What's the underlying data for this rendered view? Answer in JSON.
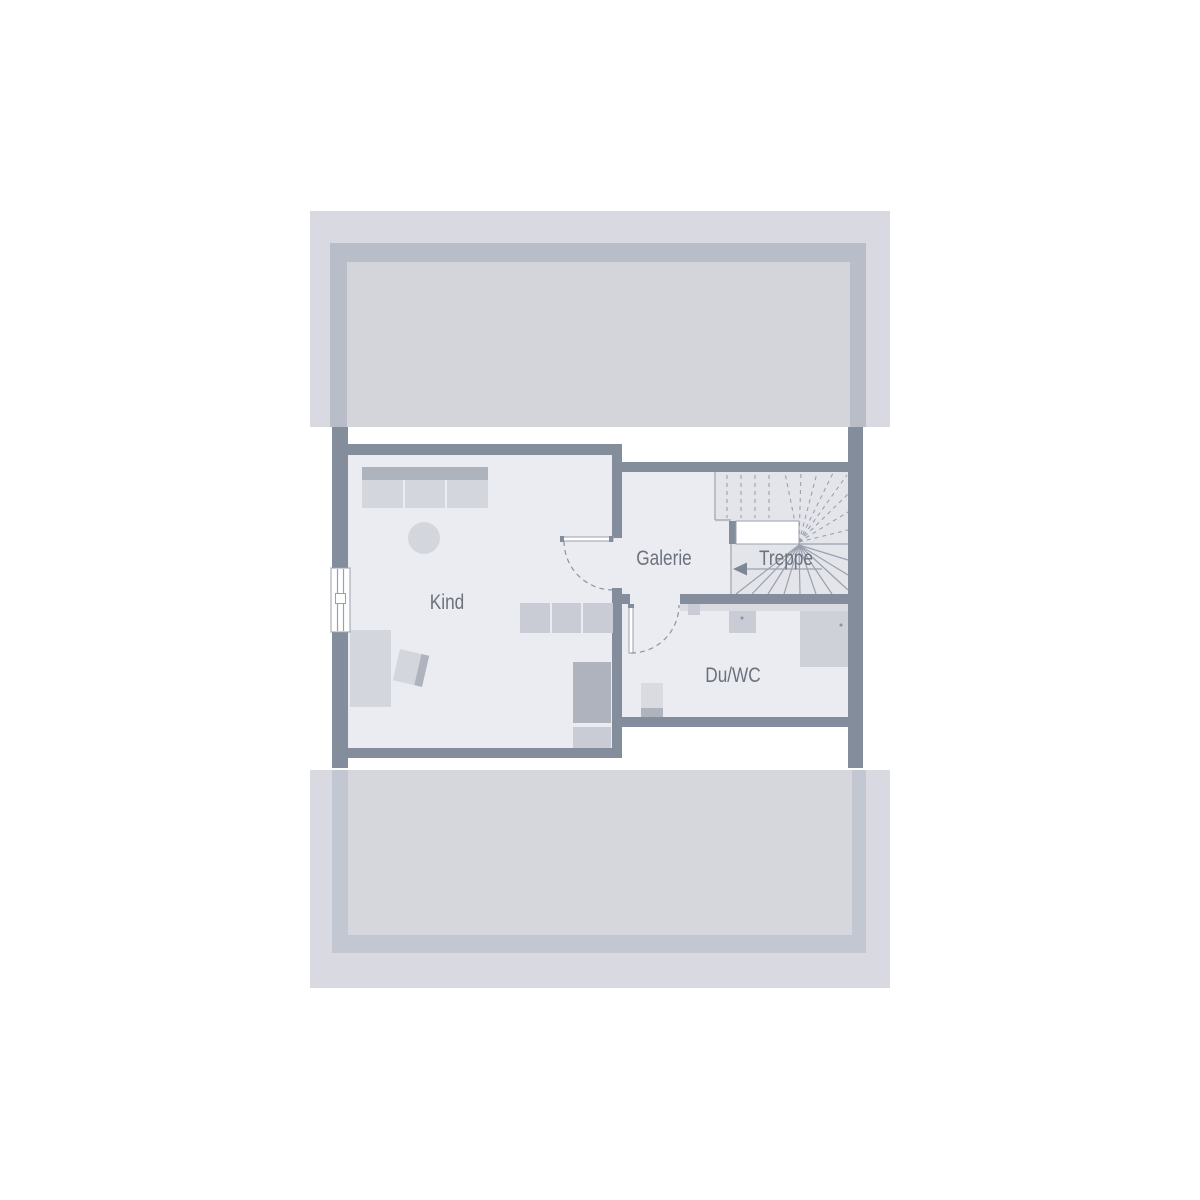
{
  "plan": {
    "type": "floorplan",
    "rooms": [
      {
        "id": "kind",
        "label": "Kind"
      },
      {
        "id": "galerie",
        "label": "Galerie"
      },
      {
        "id": "treppe",
        "label": "Treppe"
      },
      {
        "id": "duwc",
        "label": "Du/WC"
      }
    ],
    "symbols": {
      "stair_direction_arrow": "left",
      "window_count": 1,
      "door_count": 2
    }
  },
  "colors": {
    "background": "#ffffff",
    "wall": "#848d9c",
    "roof_outer": "#d9dae1",
    "roof_inner_top": "#d3d5db",
    "roof_inner_bottom": "#d6d7dd",
    "roof_wall_top": "#b9bdc7",
    "roof_wall_bottom": "#c3c7d1",
    "floor": "#eaecf1",
    "stair_floor": "#e3e5eb",
    "furniture_light": "#d4d6dd",
    "furniture_medium": "#c9ccd4",
    "furniture_dark": "#aeb3bd",
    "fixture": "#ced1d8",
    "fixture_light": "#d9dbe1",
    "line": "#9aa1ad",
    "dash": "#8b93a1",
    "text": "#6b717d",
    "arrow": "#7e8695"
  }
}
